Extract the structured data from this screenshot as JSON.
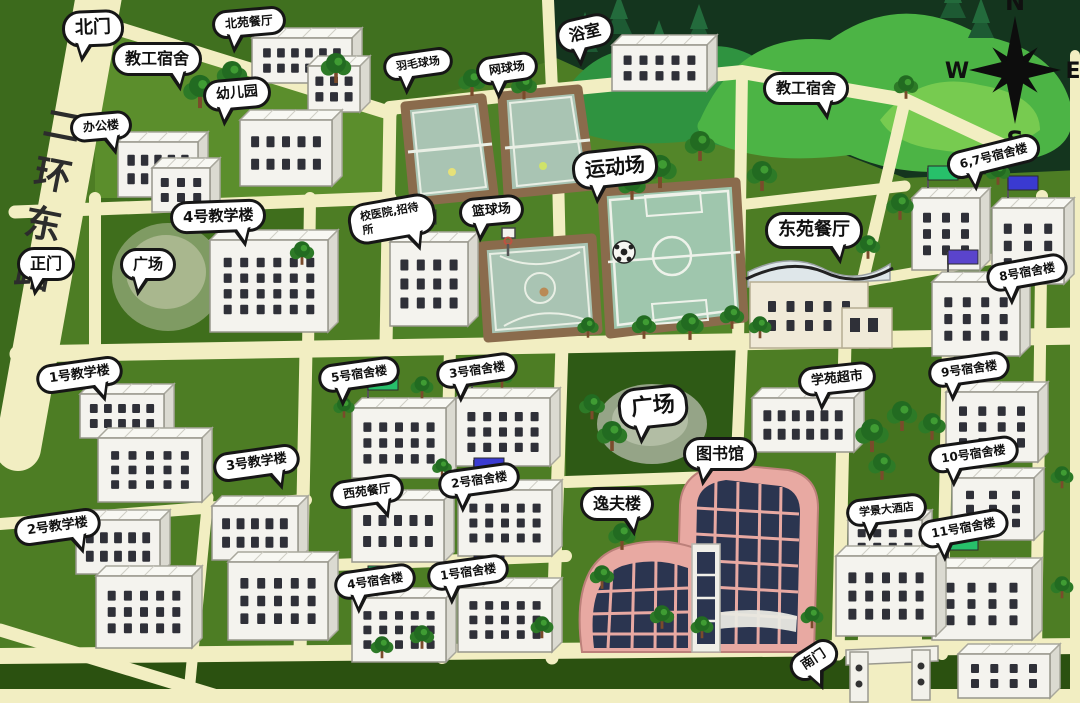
{
  "map": {
    "road_name": "二环东路",
    "compass": {
      "n": "N",
      "e": "E",
      "s": "S",
      "w": "W"
    },
    "labels": {
      "north_gate": "北门",
      "faculty_dorm_nw": "教工宿舍",
      "beiyuan_dining": "北苑餐厅",
      "kindergarten": "幼儿园",
      "office_building": "办公楼",
      "teaching_4": "4号教学楼",
      "main_gate": "正门",
      "square_west": "广场",
      "badminton_court": "羽毛球场",
      "tennis_court": "网球场",
      "bathhouse": "浴室",
      "sports_field": "运动场",
      "basketball_court": "篮球场",
      "hospital_guesthouse": "校医院,招待所",
      "faculty_dorm_ne": "教工宿舍",
      "dongyuan_dining": "东苑餐厅",
      "dorm_6_7": "6,7号宿舍楼",
      "dorm_8": "8号宿舍楼",
      "teaching_1": "1号教学楼",
      "teaching_3": "3号教学楼",
      "teaching_2": "2号教学楼",
      "dorm_5": "5号宿舍楼",
      "dorm_3": "3号宿舍楼",
      "xiyuan_dining": "西苑餐厅",
      "dorm_2": "2号宿舍楼",
      "dorm_4": "4号宿舍楼",
      "dorm_1": "1号宿舍楼",
      "square_center": "广场",
      "supermarket": "学苑超市",
      "library": "图书馆",
      "yifu_building": "逸夫楼",
      "dorm_9": "9号宿舍楼",
      "dorm_10": "10号宿舍楼",
      "hotel": "学景大酒店",
      "dorm_11": "11号宿舍楼",
      "south_gate": "南门"
    },
    "icons": {
      "soccer_ball": "⚽",
      "compass_star": "✦"
    },
    "colors": {
      "grass": "#4d7d24",
      "grass_dark": "#2e5a15",
      "road": "#f2eec2",
      "bubble_bg": "#ffffff",
      "bubble_border": "#161616",
      "building": "#f4f3ee",
      "court": "#a9c4b3",
      "field": "#9fc6ad",
      "pink_building": "#e8a9a2",
      "glass": "#2b3550",
      "hill": "#4cb445",
      "forest": "#14351e",
      "flag_green": "#27c06a",
      "flag_blue": "#3a3ad1",
      "flag_purple": "#5a44cc",
      "flag_red": "#cc4444",
      "flag_teal": "#35b3a9"
    }
  }
}
